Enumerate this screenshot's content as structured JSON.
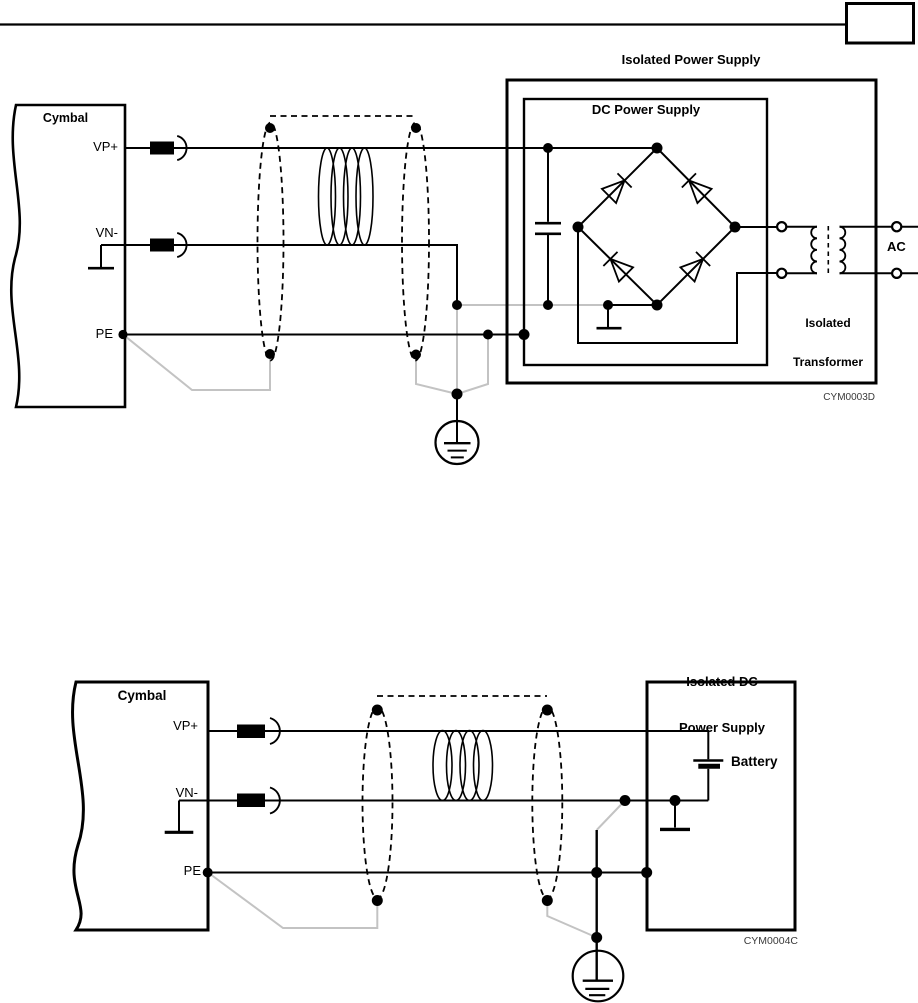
{
  "colors": {
    "line": "#000000",
    "drain_wire": "#c3c3c3",
    "background": "#ffffff"
  },
  "diagram1": {
    "title": "Isolated Power Supply",
    "cymbal_label": "Cymbal",
    "pins": {
      "vp": "VP+",
      "vn": "VN-",
      "pe": "PE"
    },
    "dc_supply_label": "DC Power Supply",
    "transformer_label_line1": "Isolated",
    "transformer_label_line2": "Transformer",
    "ac_label": "AC",
    "figure_code": "CYM0003D"
  },
  "diagram2": {
    "title_line1": "Isolated DC",
    "title_line2": "Power Supply",
    "cymbal_label": "Cymbal",
    "pins": {
      "vp": "VP+",
      "vn": "VN-",
      "pe": "PE"
    },
    "battery_label": "Battery",
    "figure_code": "CYM0004C"
  }
}
